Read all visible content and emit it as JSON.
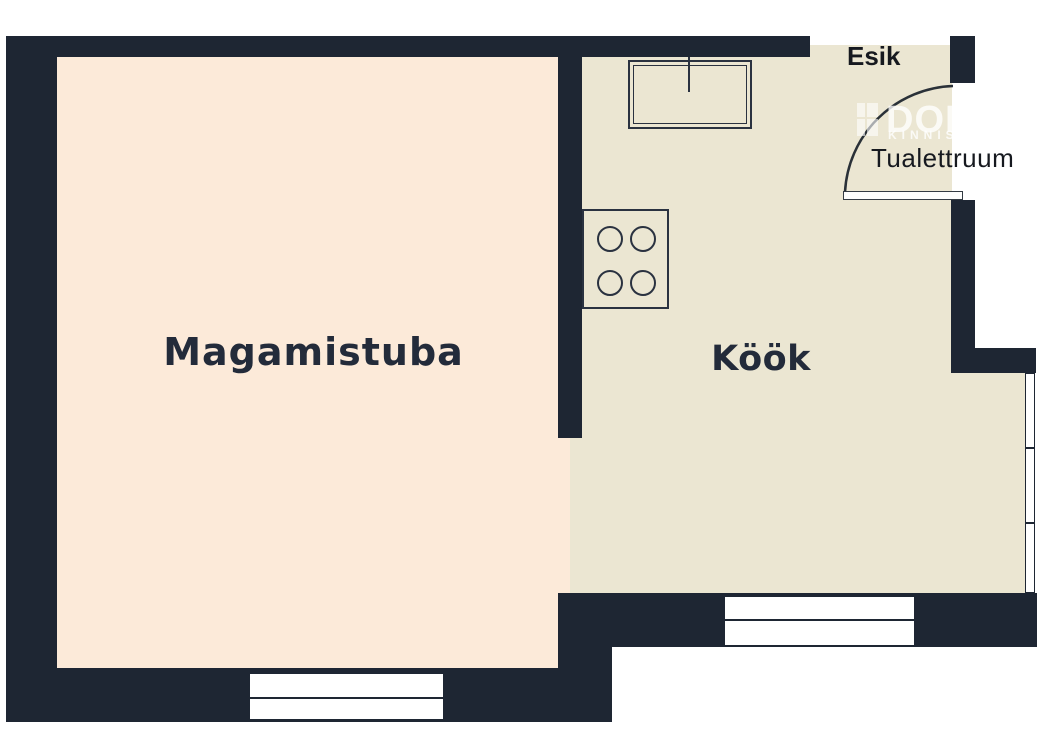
{
  "title": "Apartment floor plan",
  "rooms": {
    "bedroom": {
      "label": "Magamistuba"
    },
    "kitchen": {
      "label": "Köök"
    },
    "entry": {
      "label": "Esik"
    },
    "toilet": {
      "label": "Tualettruum"
    }
  },
  "watermark": {
    "brand": "DOM",
    "sub": "KINNIS"
  },
  "fixtures": {
    "sink": "kitchen-sink-with-faucet",
    "stove": "stove-four-burners",
    "door": "entry-door-swing-arc",
    "windows": [
      "bedroom-window-2-panes",
      "kitchen-window-2-panes",
      "right-window-3-panes"
    ]
  },
  "colors": {
    "wall": "#1e2633",
    "line": "#2a3240",
    "bedroom_floor": "#fcead9",
    "kitchen_floor": "#ebe6d2",
    "label_text": "#232b3a",
    "outside": "#ffffff"
  }
}
